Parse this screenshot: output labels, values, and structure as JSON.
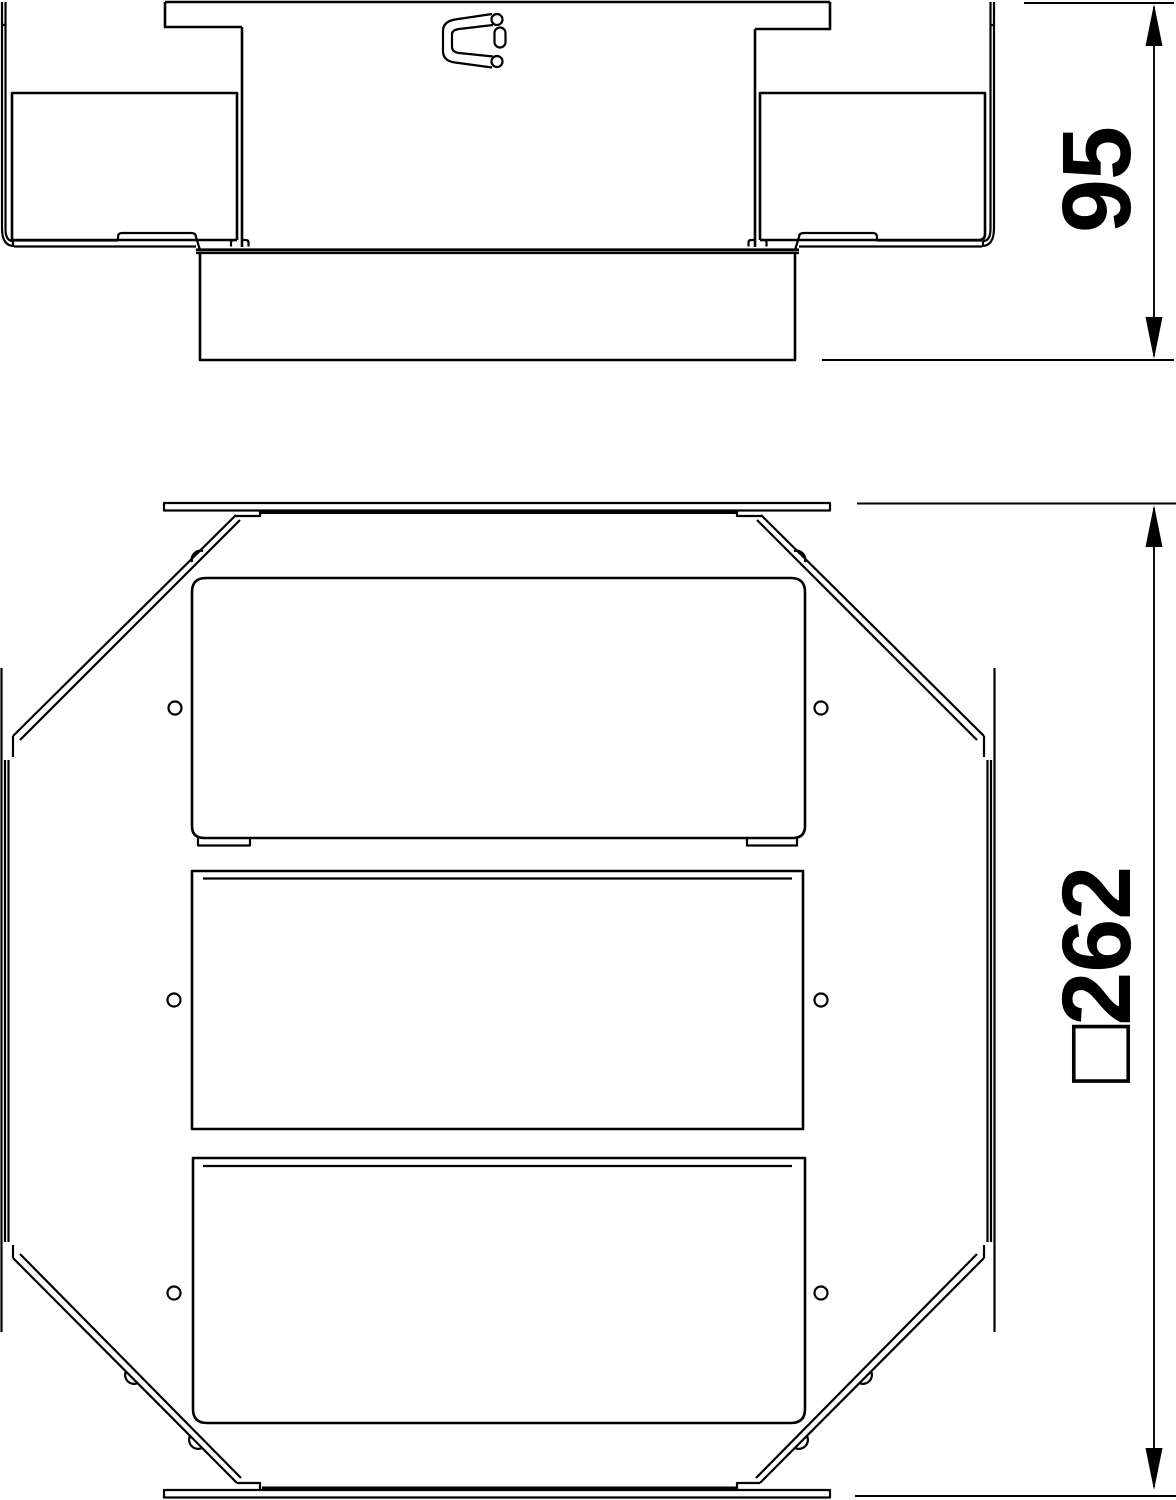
{
  "drawing": {
    "background_color": "#ffffff",
    "line_color": "#000000",
    "dimensions": {
      "height": {
        "value": "95"
      },
      "width": {
        "value": "□262"
      }
    }
  }
}
